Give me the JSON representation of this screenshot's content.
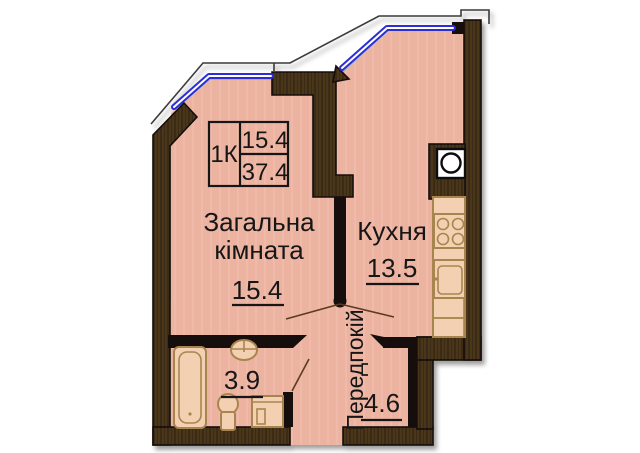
{
  "plan_title": "1-room apartment floor plan",
  "info_box": {
    "type_label": "1К",
    "living_area": "15.4",
    "total_area": "37.4"
  },
  "rooms": {
    "living": {
      "label_line1": "Загальна",
      "label_line2": "кімната",
      "area": "15.4"
    },
    "kitchen": {
      "label": "Кухня",
      "area": "13.5"
    },
    "bathroom": {
      "area": "3.9"
    },
    "hallway": {
      "label": "Передпокій",
      "area": "4.6"
    }
  },
  "colors": {
    "floor": "#edb3a1",
    "wall_dark": "#3a2a16",
    "wall_grain": "#55401f",
    "window_blue": "#2a2fd4",
    "fixture": "#a8854f",
    "fixture_fill": "#f4d0b2"
  }
}
